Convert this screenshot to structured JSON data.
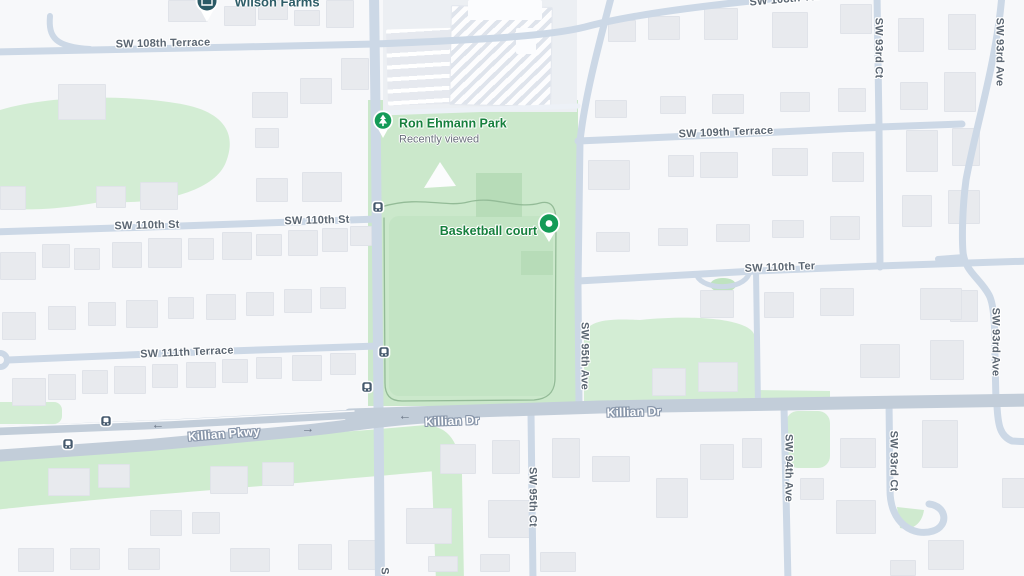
{
  "map": {
    "poi": {
      "wilson_farms": {
        "name": "Wilson Farms"
      },
      "ron_ehmann_park": {
        "name": "Ron Ehmann Park",
        "subtitle": "Recently viewed"
      },
      "basketball_court": {
        "name": "Basketball court"
      }
    },
    "streets": {
      "sw_108th_terrace": "SW 108th Terrace",
      "sw_108th_ter_short": "SW 108th Ter",
      "sw_109th_terrace": "SW 109th Terrace",
      "sw_110th_st": "SW 110th St",
      "sw_110th_ter": "SW 110th Ter",
      "sw_111th_terrace": "SW 111th Terrace",
      "killian_pkwy": "Killian Pkwy",
      "killian_dr": "Killian Dr",
      "sw_95th_ave": "SW 95th Ave",
      "sw_95th_ct": "SW 95th Ct",
      "sw_94th_ave": "SW 94th Ave",
      "sw_93rd_ct": "SW 93rd Ct",
      "sw_93rd_ave": "SW 93rd Ave",
      "partial_s": "S"
    },
    "icons": {
      "park_pin": "tree-icon",
      "basketball_pin": "dot-pin-icon",
      "wilson_pin": "store-pin-icon",
      "bus_stop": "bus-stop-icon",
      "one_way_left": "arrow-left-icon",
      "one_way_right": "arrow-right-icon"
    },
    "colors": {
      "background": "#f7f8fa",
      "road": "#ccd8e6",
      "arterial": "#c2cdd9",
      "park_green": "#cbe8cb",
      "grass_green": "#d3edd4",
      "building": "#e8eaee",
      "street_label": "#5b6672",
      "road_label": "#fdfeff",
      "poi_green": "#157f3c",
      "poi_teal": "#2e5d68",
      "transit": "#45596d",
      "pin_green": "#149b57"
    },
    "buildings": [
      [
        168,
        0,
        38,
        20
      ],
      [
        224,
        6,
        30,
        18
      ],
      [
        258,
        0,
        28,
        18
      ],
      [
        294,
        10,
        24,
        14
      ],
      [
        326,
        0,
        26,
        26
      ],
      [
        341,
        58,
        26,
        30
      ],
      [
        300,
        78,
        30,
        24
      ],
      [
        58,
        84,
        46,
        34
      ],
      [
        252,
        92,
        34,
        24
      ],
      [
        255,
        128,
        22,
        18
      ],
      [
        96,
        186,
        28,
        20
      ],
      [
        140,
        182,
        36,
        26
      ],
      [
        256,
        178,
        30,
        22
      ],
      [
        302,
        172,
        38,
        28
      ],
      [
        0,
        186,
        24,
        22
      ],
      [
        0,
        252,
        34,
        26
      ],
      [
        42,
        244,
        26,
        22
      ],
      [
        74,
        248,
        24,
        20
      ],
      [
        112,
        242,
        28,
        24
      ],
      [
        148,
        238,
        32,
        28
      ],
      [
        188,
        238,
        24,
        20
      ],
      [
        222,
        232,
        28,
        26
      ],
      [
        256,
        234,
        24,
        20
      ],
      [
        288,
        230,
        28,
        24
      ],
      [
        322,
        228,
        24,
        22
      ],
      [
        350,
        226,
        20,
        18
      ],
      [
        2,
        312,
        32,
        26
      ],
      [
        48,
        306,
        26,
        22
      ],
      [
        88,
        302,
        26,
        22
      ],
      [
        126,
        300,
        30,
        26
      ],
      [
        168,
        297,
        24,
        20
      ],
      [
        206,
        294,
        28,
        24
      ],
      [
        246,
        292,
        26,
        22
      ],
      [
        284,
        289,
        26,
        22
      ],
      [
        320,
        287,
        24,
        20
      ],
      [
        12,
        378,
        32,
        26
      ],
      [
        48,
        374,
        26,
        24
      ],
      [
        82,
        370,
        24,
        22
      ],
      [
        114,
        366,
        30,
        26
      ],
      [
        152,
        364,
        24,
        22
      ],
      [
        186,
        362,
        28,
        24
      ],
      [
        222,
        359,
        24,
        22
      ],
      [
        256,
        357,
        24,
        20
      ],
      [
        292,
        355,
        28,
        24
      ],
      [
        330,
        353,
        24,
        20
      ],
      [
        48,
        468,
        40,
        26
      ],
      [
        98,
        464,
        30,
        22
      ],
      [
        210,
        466,
        36,
        26
      ],
      [
        262,
        462,
        30,
        22
      ],
      [
        150,
        510,
        30,
        24
      ],
      [
        192,
        512,
        26,
        20
      ],
      [
        18,
        548,
        34,
        22
      ],
      [
        70,
        548,
        28,
        20
      ],
      [
        128,
        548,
        30,
        20
      ],
      [
        230,
        548,
        38,
        22
      ],
      [
        298,
        544,
        32,
        24
      ],
      [
        348,
        540,
        26,
        28
      ],
      [
        406,
        508,
        44,
        34
      ],
      [
        428,
        556,
        28,
        14
      ],
      [
        488,
        500,
        44,
        36
      ],
      [
        480,
        554,
        28,
        16
      ],
      [
        540,
        552,
        34,
        18
      ],
      [
        440,
        444,
        34,
        28
      ],
      [
        492,
        440,
        26,
        32
      ],
      [
        552,
        438,
        26,
        38
      ],
      [
        592,
        456,
        36,
        24
      ],
      [
        656,
        478,
        30,
        38
      ],
      [
        700,
        444,
        32,
        34
      ],
      [
        742,
        438,
        18,
        28
      ],
      [
        800,
        478,
        22,
        20
      ],
      [
        840,
        438,
        34,
        28
      ],
      [
        836,
        500,
        38,
        32
      ],
      [
        922,
        420,
        34,
        46
      ],
      [
        928,
        540,
        34,
        28
      ],
      [
        1002,
        478,
        22,
        28
      ],
      [
        890,
        560,
        24,
        14
      ],
      [
        608,
        20,
        26,
        20
      ],
      [
        648,
        16,
        30,
        22
      ],
      [
        704,
        8,
        32,
        30
      ],
      [
        772,
        12,
        34,
        34
      ],
      [
        840,
        4,
        30,
        28
      ],
      [
        595,
        100,
        30,
        16
      ],
      [
        660,
        96,
        24,
        16
      ],
      [
        712,
        94,
        30,
        18
      ],
      [
        780,
        92,
        28,
        18
      ],
      [
        838,
        88,
        26,
        22
      ],
      [
        588,
        160,
        40,
        28
      ],
      [
        668,
        155,
        24,
        20
      ],
      [
        700,
        152,
        36,
        24
      ],
      [
        772,
        148,
        34,
        26
      ],
      [
        832,
        152,
        30,
        28
      ],
      [
        596,
        232,
        32,
        18
      ],
      [
        658,
        228,
        28,
        16
      ],
      [
        716,
        224,
        32,
        16
      ],
      [
        772,
        220,
        30,
        16
      ],
      [
        830,
        216,
        28,
        22
      ],
      [
        898,
        18,
        24,
        32
      ],
      [
        948,
        14,
        26,
        34
      ],
      [
        900,
        82,
        26,
        26
      ],
      [
        944,
        72,
        30,
        38
      ],
      [
        906,
        130,
        30,
        40
      ],
      [
        952,
        128,
        26,
        36
      ],
      [
        902,
        195,
        28,
        30
      ],
      [
        948,
        190,
        30,
        32
      ],
      [
        950,
        290,
        26,
        30
      ],
      [
        652,
        368,
        32,
        26
      ],
      [
        698,
        362,
        38,
        28
      ],
      [
        700,
        290,
        32,
        26
      ],
      [
        764,
        292,
        28,
        24
      ],
      [
        820,
        288,
        32,
        26
      ],
      [
        860,
        344,
        38,
        32
      ],
      [
        920,
        288,
        40,
        30
      ],
      [
        930,
        340,
        32,
        38
      ]
    ]
  }
}
